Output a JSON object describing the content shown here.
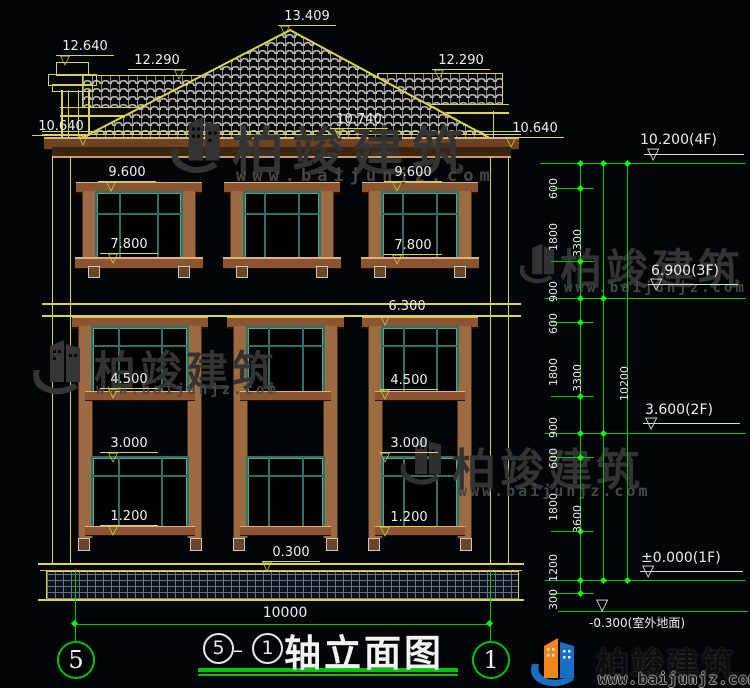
{
  "watermark": {
    "brand": "柏竣建筑",
    "url": "www.baijunjz.com"
  },
  "footer_logo": {
    "brand": "柏竣建筑",
    "url": "www.baijunjz.com"
  },
  "title_block": {
    "title": "轴立面图",
    "axis_start": "5",
    "axis_end": "1",
    "separator": "–"
  },
  "axis_bubbles": {
    "left": "5",
    "right": "1"
  },
  "bottom_dim": "10000",
  "dims": [
    "13.409",
    "12.640",
    "12.290",
    "12.290",
    "10.640",
    "10.740",
    "10.640",
    "9.600",
    "9.600",
    "7.800",
    "7.800",
    "6.300",
    "4.500",
    "4.500",
    "3.000",
    "3.000",
    "1.200",
    "1.200",
    "0.300"
  ],
  "chain": {
    "col1": [
      "600",
      "1800",
      "900",
      "600",
      "1800",
      "900",
      "600",
      "1800",
      "1200",
      "300"
    ],
    "col2": [
      "3300",
      "3300",
      "3600"
    ],
    "total": "10200"
  },
  "levels": [
    "10.200(4F)",
    "6.900(3F)",
    "3.600(2F)",
    "±0.000(1F)",
    "-0.300(室外地面)"
  ]
}
